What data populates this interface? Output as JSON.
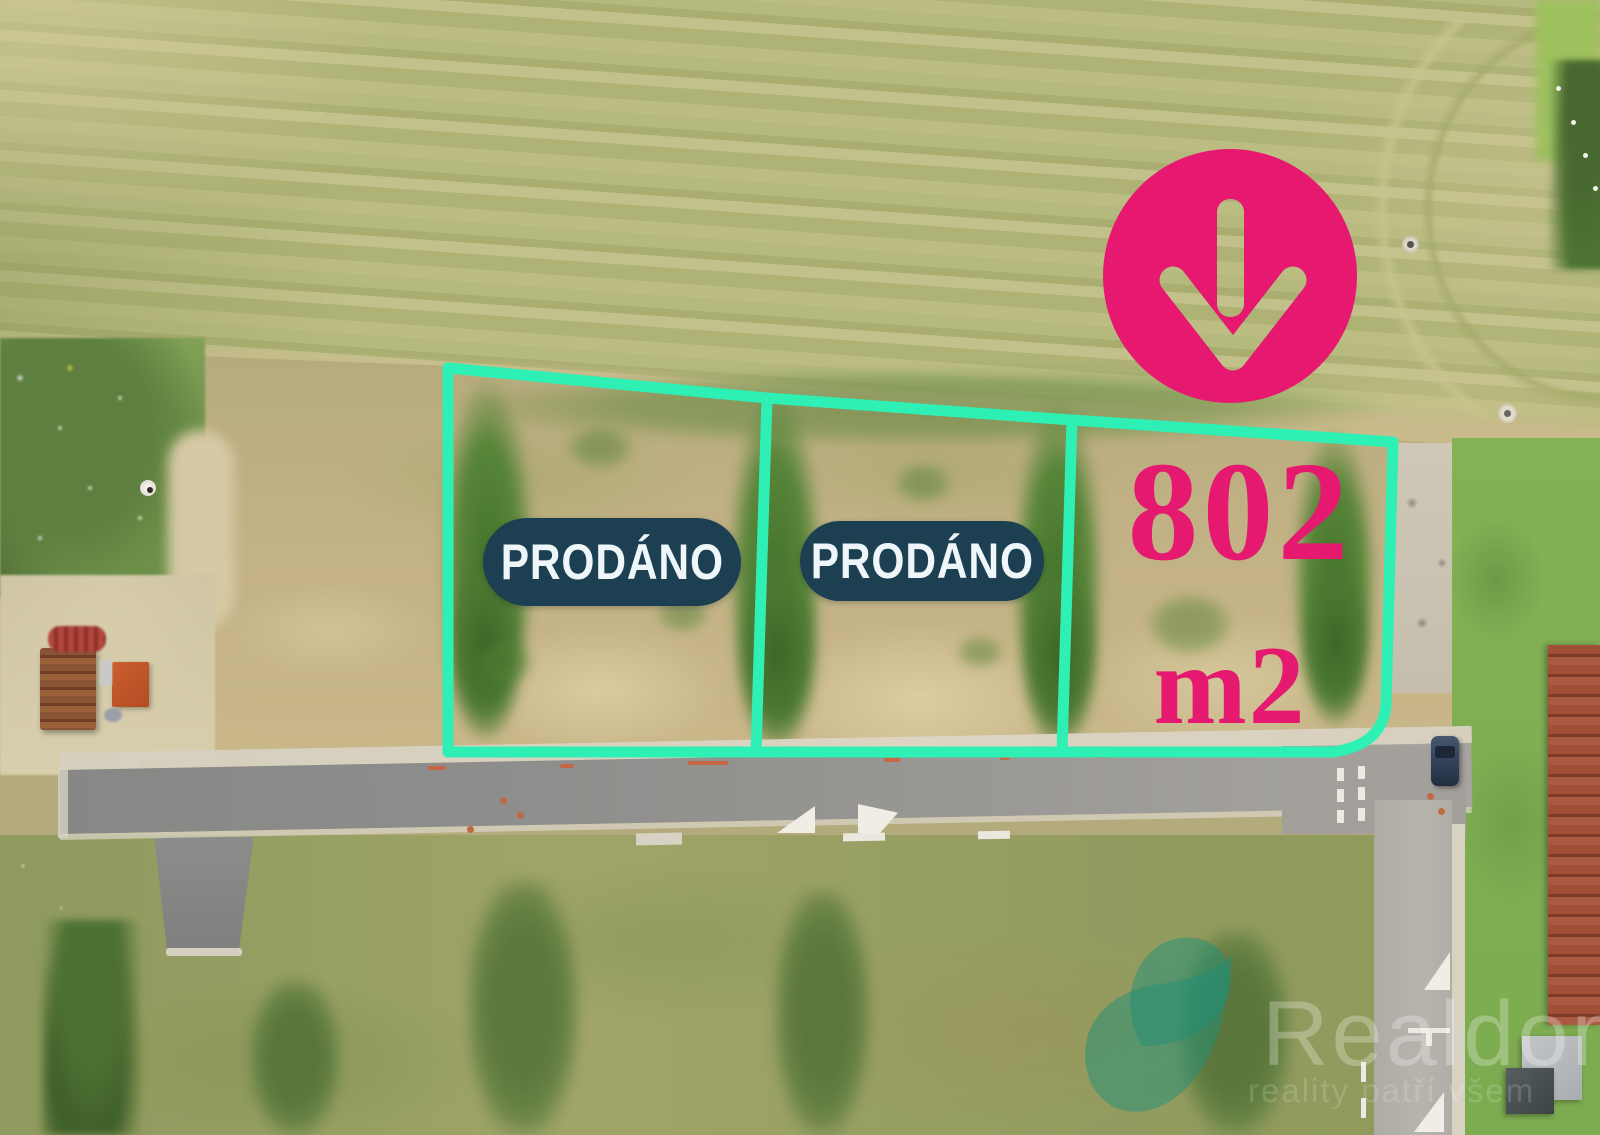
{
  "overlay": {
    "plots": [
      {
        "name": "plot-1",
        "badge": "PRODÁNO"
      },
      {
        "name": "plot-2",
        "badge": "PRODÁNO"
      },
      {
        "name": "plot-3",
        "area": "802",
        "unit": "m2"
      }
    ],
    "arrow_icon": "arrow-down-icon"
  },
  "watermark": {
    "brand": "Realdomus",
    "tagline": "reality patří všem"
  },
  "colors": {
    "outline_teal": "#2ef0b4",
    "accent_pink": "#e6186f",
    "badge_navy": "#1c4052",
    "watermark_teal": "#1f8f78"
  }
}
